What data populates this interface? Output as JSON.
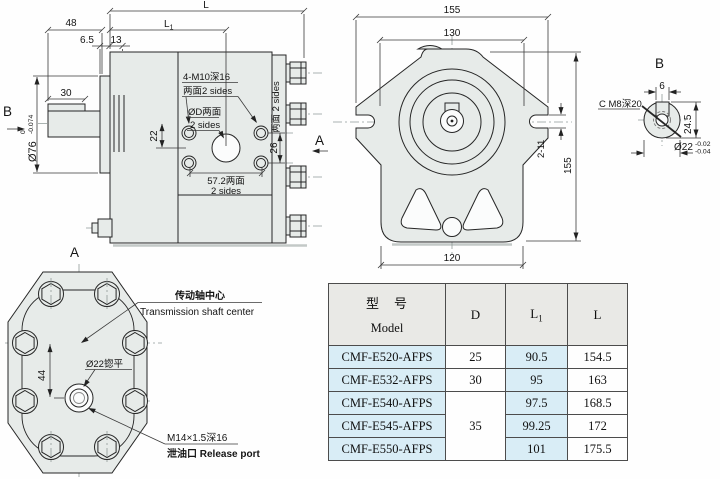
{
  "side": {
    "l": "L",
    "l1_main": "L",
    "l1_sub": "1",
    "d48": "48",
    "d6_5": "6.5",
    "d13": "13",
    "d30": "30",
    "dia76": "Ø76",
    "tol_zero": "0",
    "tol_074": "-0.074",
    "d22": "22",
    "d26": "26",
    "note_m10_1": "4-M10深16",
    "note_m10_2": "两面2 sides",
    "note_od_1": "ØD两面",
    "note_od_2": "2 sides",
    "d57_1": "57.2两面",
    "d57_2": "2 sides",
    "note_sides_v": "两面 2 sides",
    "label_a": "A",
    "label_b": "B"
  },
  "front": {
    "w155": "155",
    "w130": "130",
    "slot": "2-11",
    "h155": "155",
    "w120": "120"
  },
  "detailb": {
    "label": "B",
    "note_c_m8": "C M8深20",
    "d6": "6",
    "d24_5": "24.5",
    "dia22": "Ø22",
    "tol_hi": "-0.02",
    "tol_lo": "-0.04"
  },
  "rear": {
    "label": "A",
    "d44": "44",
    "spotface": "Ø22锪平",
    "shaft_cn": "传动轴中心",
    "shaft_en": "Transmission shaft center",
    "port_1": "M14×1.5深16",
    "port_2": "泄油口  Release port"
  },
  "table": {
    "header": {
      "model_cn": "型　号",
      "model_en": "Model",
      "d": "D",
      "l1_main": "L",
      "l1_sub": "1",
      "l": "L"
    },
    "d_merged": "35",
    "rows": [
      {
        "model": "CMF-E520-AFPS",
        "d": "25",
        "l1": "90.5",
        "l": "154.5"
      },
      {
        "model": "CMF-E532-AFPS",
        "d": "30",
        "l1": "95",
        "l": "163"
      },
      {
        "model": "CMF-E540-AFPS",
        "d": "",
        "l1": "97.5",
        "l": "168.5"
      },
      {
        "model": "CMF-E545-AFPS",
        "d": "",
        "l1": "99.25",
        "l": "172"
      },
      {
        "model": "CMF-E550-AFPS",
        "d": "",
        "l1": "101",
        "l": "175.5"
      }
    ]
  }
}
